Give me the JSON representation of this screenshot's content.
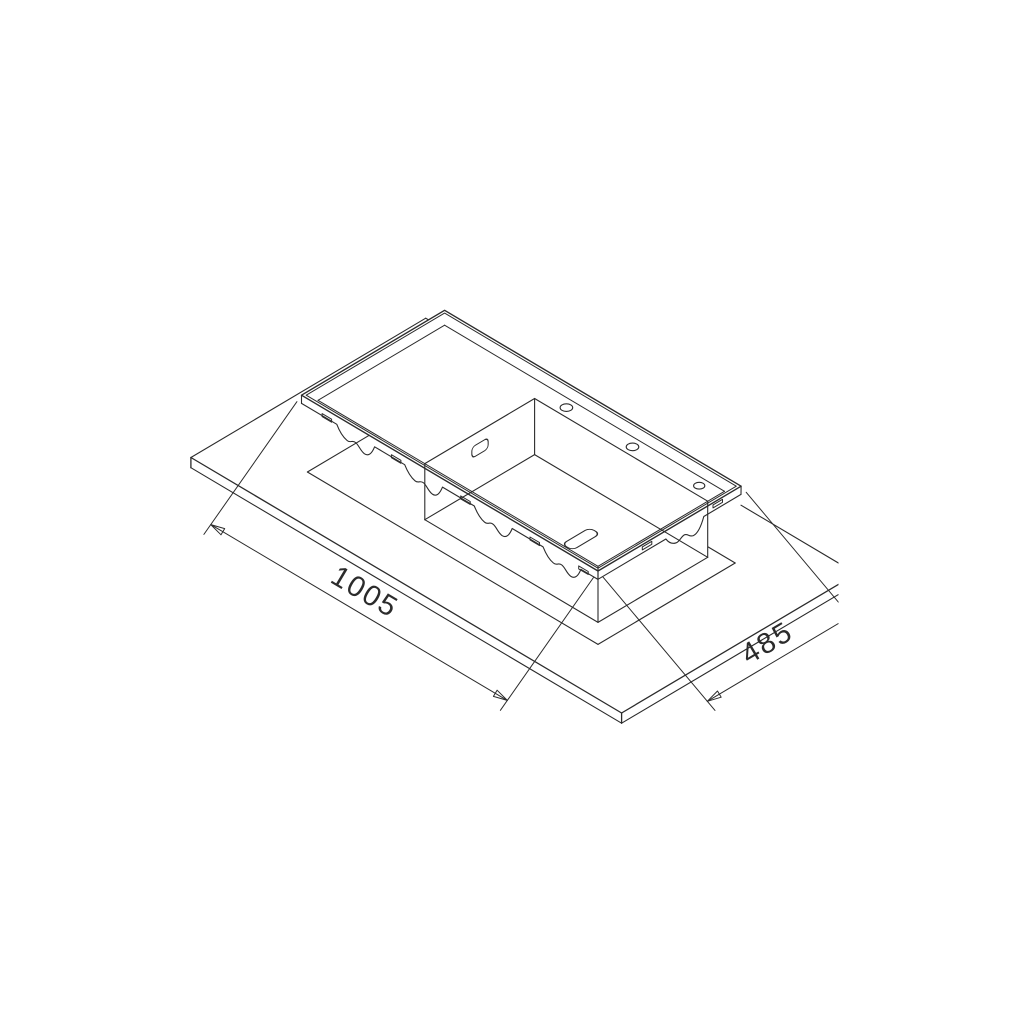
{
  "diagram": {
    "type": "isometric technical drawing",
    "subject": "inset kitchen sink with drainer shown exploded above countertop cutout",
    "background_color": "#ffffff",
    "line_color": "#2b2b2b",
    "dimensions": {
      "length": {
        "label": "1005",
        "value": 1005
      },
      "width": {
        "label": "485",
        "value": 485
      }
    },
    "features": [
      "countertop-slab",
      "countertop-cutout",
      "sink-rim-flange",
      "drainer-deck",
      "bowl",
      "tap-hole",
      "tap-hole",
      "tap-hole",
      "overflow-hole",
      "drain-hole",
      "mounting-clip-tabs",
      "mounting-clip-brackets",
      "dimension-line-length",
      "dimension-line-width"
    ]
  }
}
